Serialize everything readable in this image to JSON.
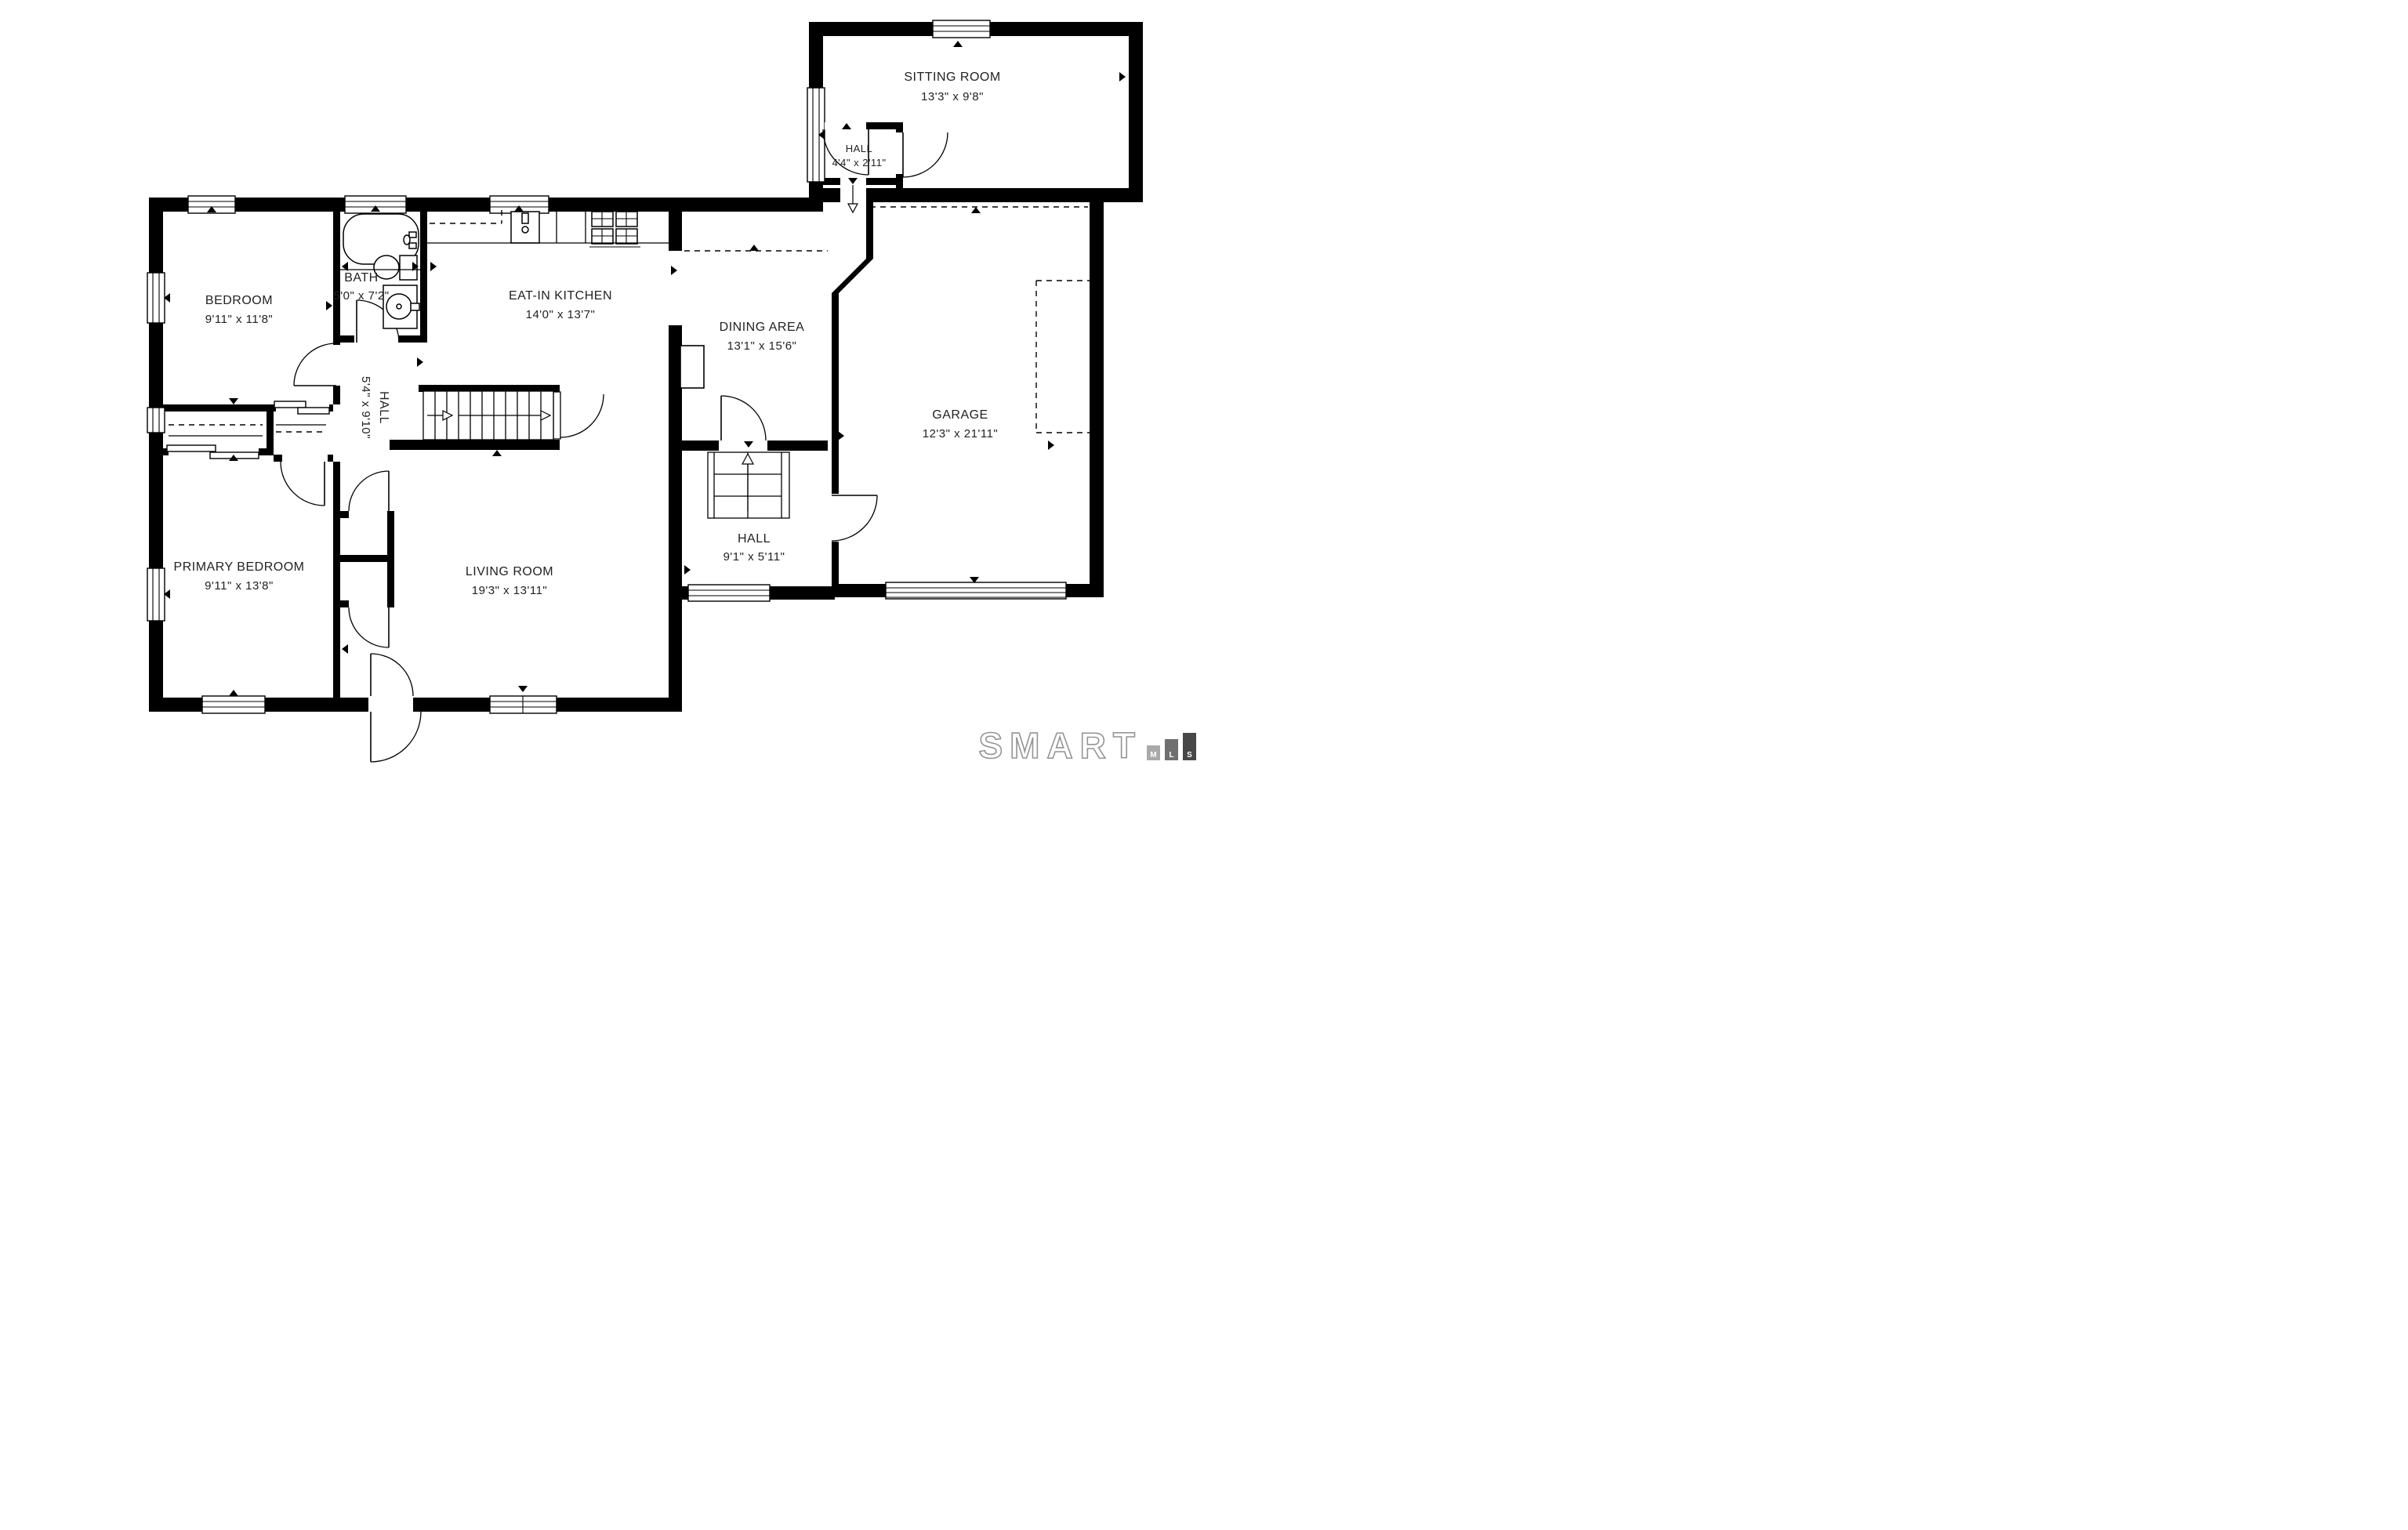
{
  "floorplan": {
    "rooms": [
      {
        "name": "SITTING ROOM",
        "dims": "13'3\" x 9'8\""
      },
      {
        "name": "HALL",
        "dims": "4'4\" x 2'11\""
      },
      {
        "name": "BEDROOM",
        "dims": "9'11\" x 11'8\""
      },
      {
        "name": "BATH",
        "dims": "5'0\" x 7'2\""
      },
      {
        "name": "EAT-IN KITCHEN",
        "dims": "14'0\" x 13'7\""
      },
      {
        "name": "DINING AREA",
        "dims": "13'1\" x 15'6\""
      },
      {
        "name": "GARAGE",
        "dims": "12'3\" x 21'11\""
      },
      {
        "name": "HALL",
        "dims": "5'4\" x 9'10\""
      },
      {
        "name": "PRIMARY BEDROOM",
        "dims": "9'11\" x 13'8\""
      },
      {
        "name": "LIVING ROOM",
        "dims": "19'3\" x 13'11\""
      },
      {
        "name": "HALL",
        "dims": "9'1\" x 5'11\""
      }
    ]
  },
  "logo": {
    "brand": "SMART",
    "mls": [
      "M",
      "L",
      "S"
    ]
  },
  "colors": {
    "walls": "#000000",
    "background": "#ffffff",
    "text": "#222222",
    "logo_outline": "#949494",
    "mls_m": "#a9a9a9",
    "mls_l": "#6f6f6f",
    "mls_s": "#474747"
  }
}
